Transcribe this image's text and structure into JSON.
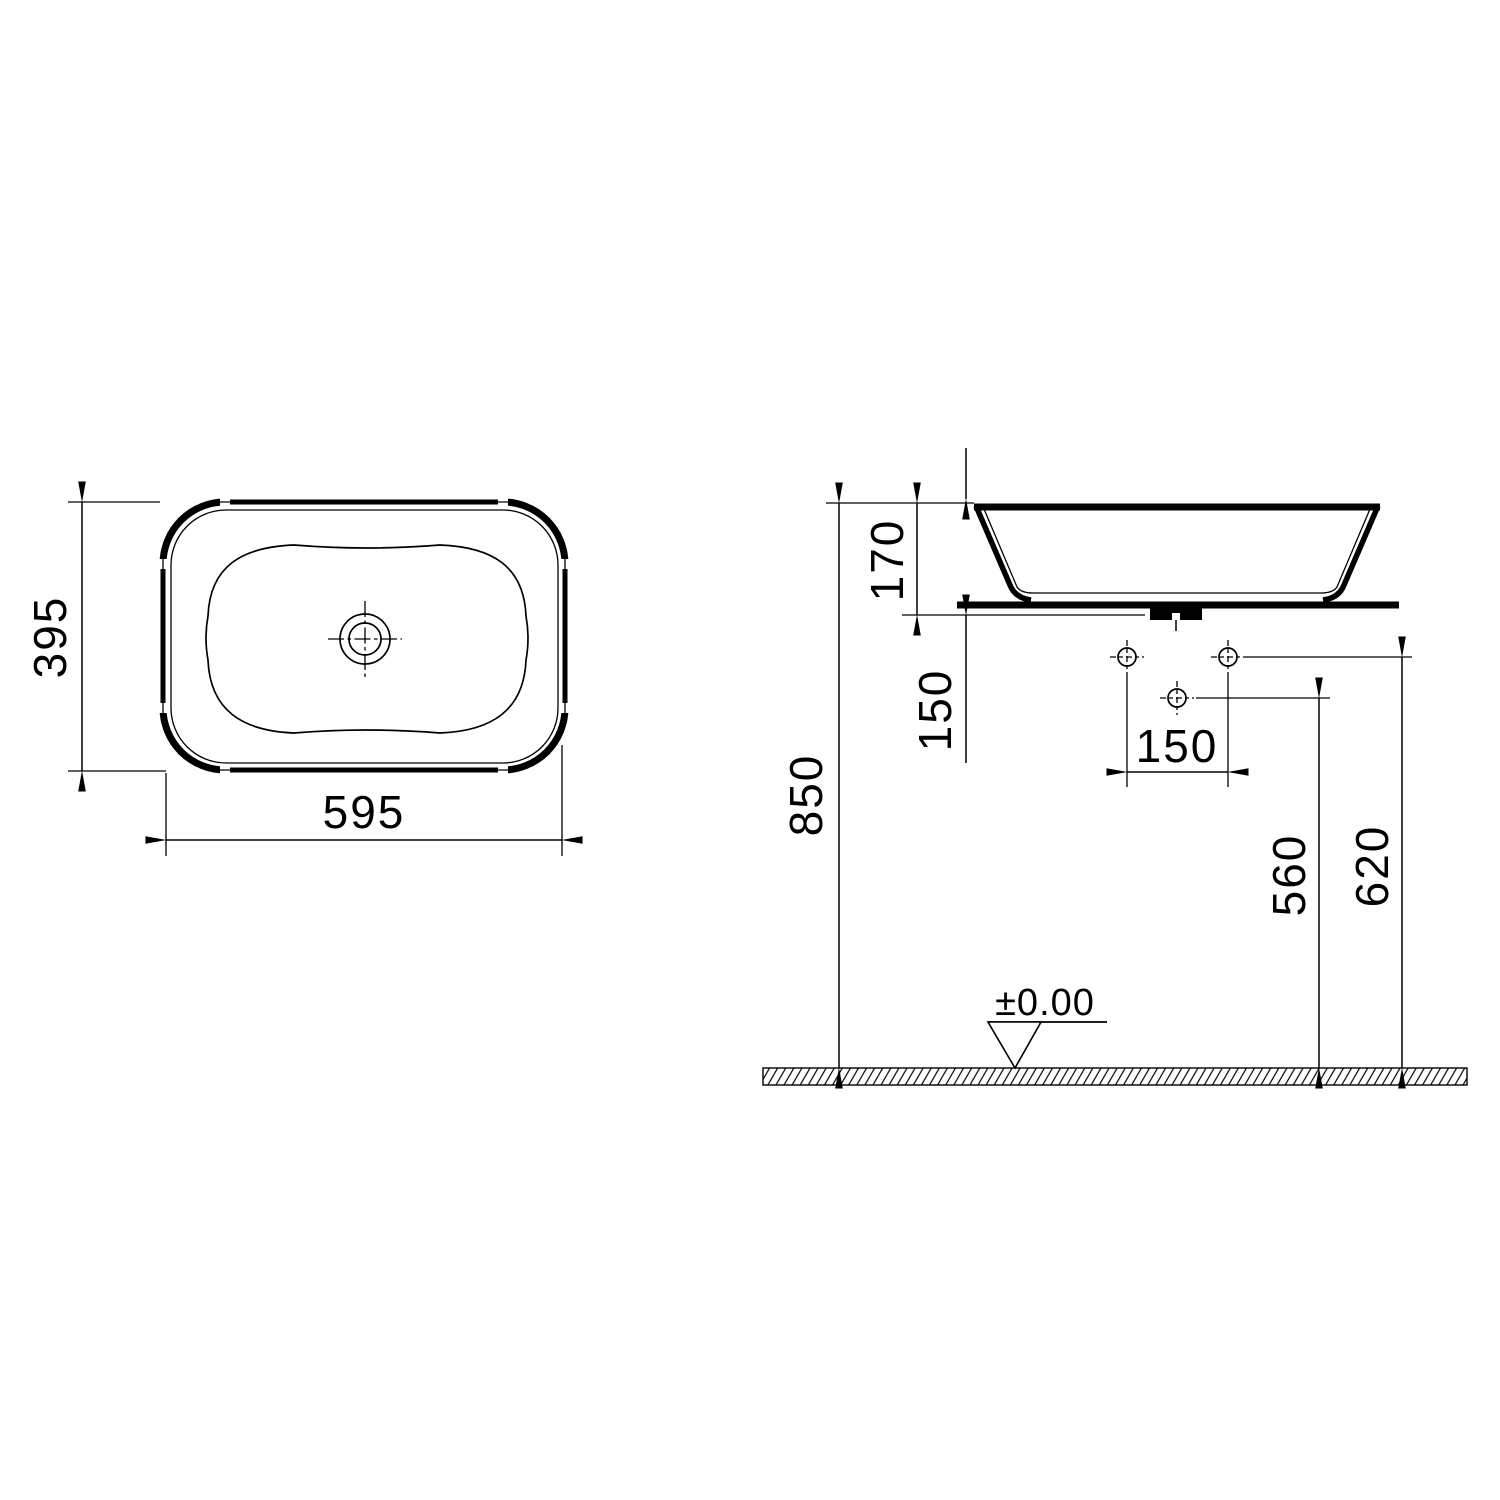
{
  "drawing": {
    "background_color": "#ffffff",
    "line_color": "#000000",
    "top_view": {
      "width_dim": "595",
      "depth_dim": "395"
    },
    "side_view": {
      "overall_height_dim": "170",
      "counter_to_hole_dim": "150",
      "hole_spacing_dim": "150",
      "rim_height_dim": "850",
      "middle_hole_height_dim": "560",
      "side_holes_height_dim": "620",
      "floor_level_label": "±0.00"
    }
  }
}
